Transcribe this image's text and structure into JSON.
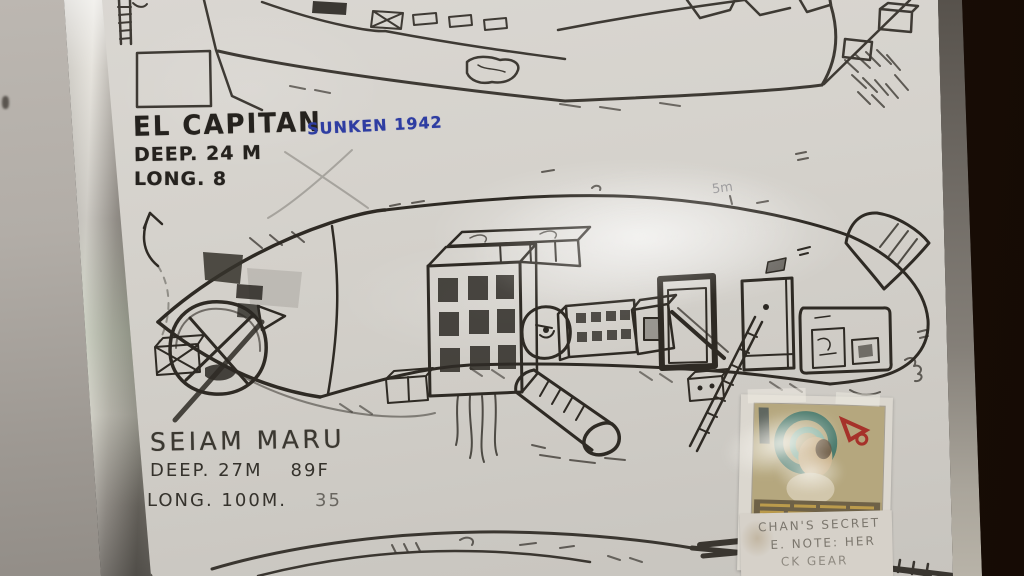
{
  "labels": {
    "wreck1": {
      "name": "EL CAPITAN",
      "sunken": "SUNKEN 1942",
      "depth": "DEEP. 24 M",
      "length": "LONG. 8"
    },
    "wreck2": {
      "name": "SEIAM MARU",
      "depth": "DEEP. 27M",
      "depth_ft": "89F",
      "length": "LONG. 100M.",
      "length_ft": "35"
    },
    "annotation_5m": "5m",
    "note": {
      "line1": "CHAN'S SECRET",
      "line2": "E. NOTE: HER",
      "line3": "CK GEAR"
    }
  },
  "colors": {
    "blue_marker": "#2e3da2",
    "black_marker": "#25221e",
    "board": "#d4d1cb",
    "wall_right": "#241509",
    "clipping_paper": "#b5a77e"
  }
}
